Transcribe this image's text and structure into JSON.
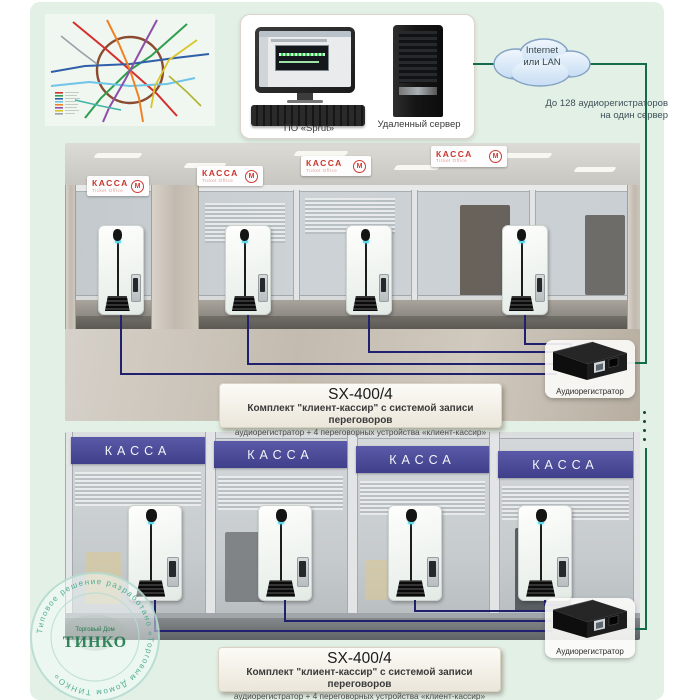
{
  "colors": {
    "background": "#e3f0e6",
    "connection_green": "#156c4b",
    "wire_navy": "#20206e",
    "kassa_red": "#c9352c",
    "banner_indigo": "#46469a",
    "stamp_teal": "#43a98e"
  },
  "top_box": {
    "computer_label": "ПО «Sprut»",
    "server_label": "Удаленный сервер"
  },
  "cloud": {
    "line1": "Internet",
    "line2": "или LAN"
  },
  "capacity_note": {
    "line1": "До 128 аудиорегистраторов",
    "line2": "на один сервер"
  },
  "recorder": {
    "label": "Аудиорегистратор"
  },
  "kit_label": {
    "model": "SX-400/4",
    "line1": "Комплект \"клиент-кассир\" с системой записи переговоров",
    "line2": "аудиорегистратор + 4 переговорных устройства «клиент-кассир»"
  },
  "top_photo": {
    "sign_title": "КАССА",
    "sign_subtitle": "Ticket Office"
  },
  "bottom_photo": {
    "banner_title": "КАССА"
  },
  "icons": {
    "metro_logo_glyph": "М"
  },
  "stamp": {
    "ring_text": "Типовое решение разработано «Торговым Домом ТИНКО»",
    "logo_top": "Торговый Дом",
    "logo_main": "ТИНКО"
  }
}
